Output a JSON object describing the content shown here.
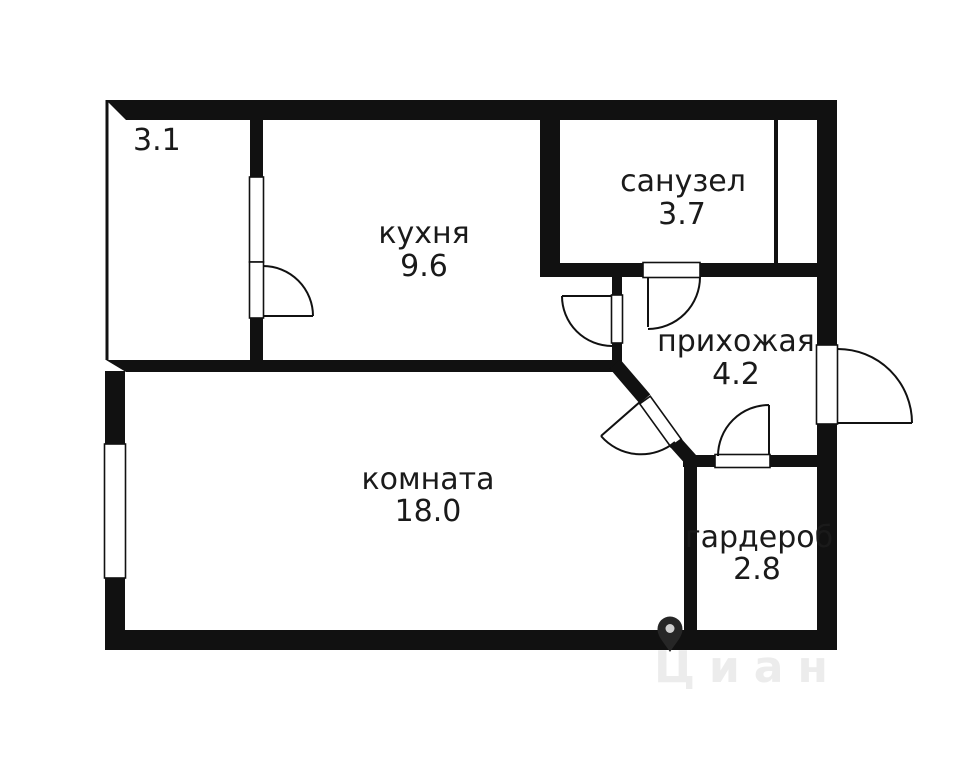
{
  "plan": {
    "type": "apartment-floor-plan",
    "rooms": [
      {
        "key": "balcony",
        "name": "",
        "area": "3.1"
      },
      {
        "key": "kitchen",
        "name": "кухня",
        "area": "9.6"
      },
      {
        "key": "bathroom",
        "name": "санузел",
        "area": "3.7"
      },
      {
        "key": "hallway",
        "name": "прихожая",
        "area": "4.2"
      },
      {
        "key": "room",
        "name": "комната",
        "area": "18.0"
      },
      {
        "key": "wardrobe",
        "name": "гардероб",
        "area": "2.8"
      }
    ]
  },
  "watermark": {
    "text": "Циан",
    "icon": "map-pin-icon"
  },
  "colors": {
    "wall": "#111111",
    "background": "#ffffff",
    "label_text": "#1a1a1a",
    "watermark_text": "#ececec",
    "watermark_pin": "#262626",
    "pin_hole": "#cfcfcf"
  }
}
